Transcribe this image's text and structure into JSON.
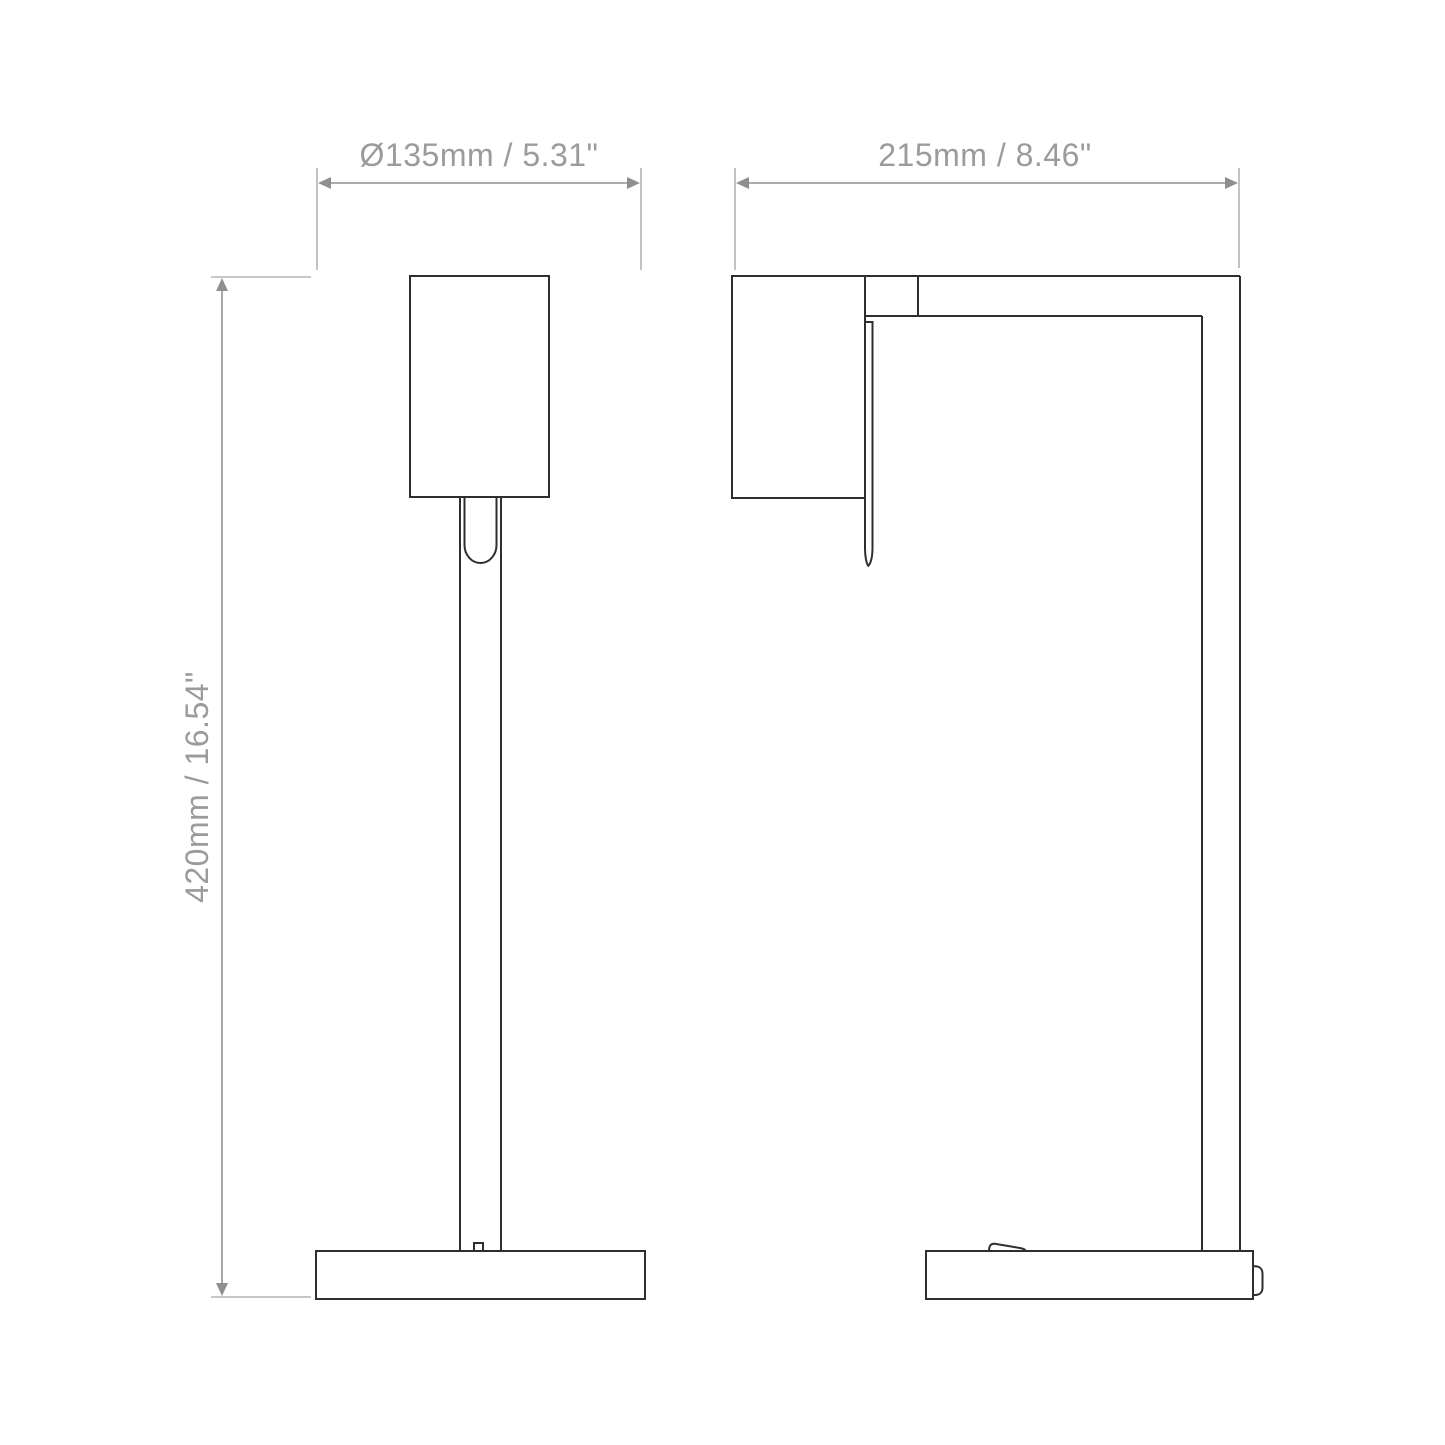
{
  "drawing": {
    "type": "technical-dimension-drawing",
    "subject": "table lamp, front and side elevation views",
    "background": "#ffffff"
  },
  "dimensions": {
    "base_diameter": {
      "label": "Ø135mm / 5.31\"",
      "value_mm": 135,
      "value_in": 5.31,
      "orientation": "horizontal"
    },
    "depth": {
      "label": "215mm / 8.46\"",
      "value_mm": 215,
      "value_in": 8.46,
      "orientation": "horizontal"
    },
    "height": {
      "label": "420mm / 16.54\"",
      "value_mm": 420,
      "value_in": 16.54,
      "orientation": "vertical"
    }
  },
  "colors": {
    "object_line": "#2e2e2e",
    "dimension_line": "#8f8f8f",
    "extension_line": "#b3b3b3",
    "label_text": "#9b9b9b",
    "background": "#ffffff"
  }
}
